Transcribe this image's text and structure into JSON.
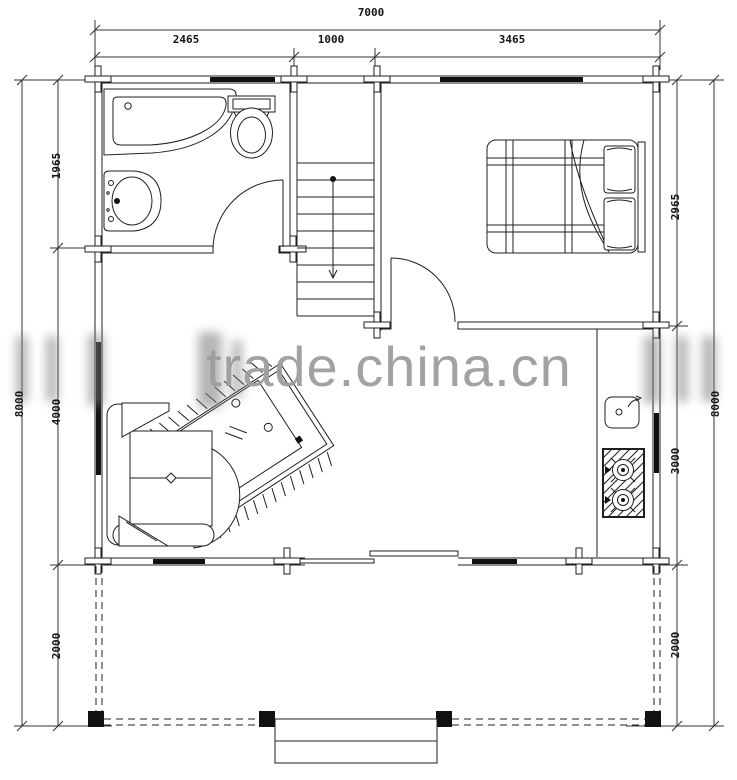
{
  "page": {
    "type": "architectural-floor-plan",
    "background": "#ffffff"
  },
  "watermark": {
    "text": "trade.china.cn",
    "color": "#9c9c9c"
  },
  "dimensions": {
    "top": {
      "total": "7000",
      "segments": [
        "2465",
        "1000",
        "3465"
      ]
    },
    "left": {
      "total": "8000",
      "upper": "1965",
      "lower": "4000",
      "porch": "2000"
    },
    "right": {
      "total": "8000",
      "upper": "2965",
      "lower": "3000",
      "porch": "2000"
    }
  },
  "icons": {
    "bathroom": [
      "corner-bathtub-icon",
      "washbasin-icon",
      "toilet-icon",
      "door-swing"
    ],
    "stairs": [
      "staircase",
      "direction-arrow"
    ],
    "bedroom": [
      "double-bed-icon",
      "pillow-icon",
      "door-swing",
      "window"
    ],
    "living_room": [
      "corner-sofa-icon",
      "rug-icon",
      "coffee-table-icon",
      "sliding-door"
    ],
    "kitchen": [
      "counter",
      "kitchen-sink-icon",
      "two-burner-stove-icon"
    ],
    "porch": [
      "post",
      "entry-steps"
    ]
  },
  "colors": {
    "line": "#1f1f1f",
    "window_fill": "#111111",
    "dim_line": "#333333"
  }
}
